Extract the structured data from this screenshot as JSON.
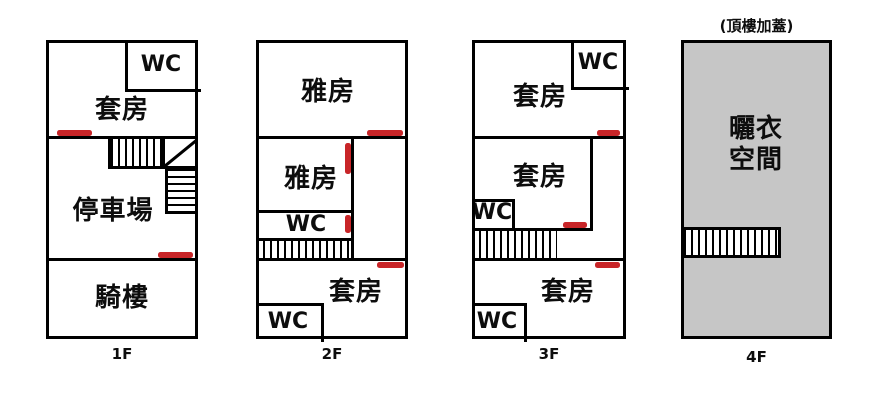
{
  "colors": {
    "red": "#c82528",
    "line": "#000000",
    "roof_fill": "#c6c6c6",
    "background": "#ffffff"
  },
  "floors": {
    "f1": {
      "label": "1F",
      "wc": "WC",
      "suite": "套房",
      "parking": "停車場",
      "arcade": "騎樓"
    },
    "f2": {
      "label": "2F",
      "room_top": "雅房",
      "room_mid": "雅房",
      "wc_mid": "WC",
      "suite_bottom": "套房",
      "wc_bottom": "WC"
    },
    "f3": {
      "label": "3F",
      "wc_top": "WC",
      "suite_top": "套房",
      "suite_mid": "套房",
      "wc_mid": "WC",
      "suite_bottom": "套房",
      "wc_bottom": "WC"
    },
    "f4": {
      "label": "4F",
      "annotation": "(頂樓加蓋)",
      "space_line1": "曬衣",
      "space_line2": "空間"
    }
  }
}
